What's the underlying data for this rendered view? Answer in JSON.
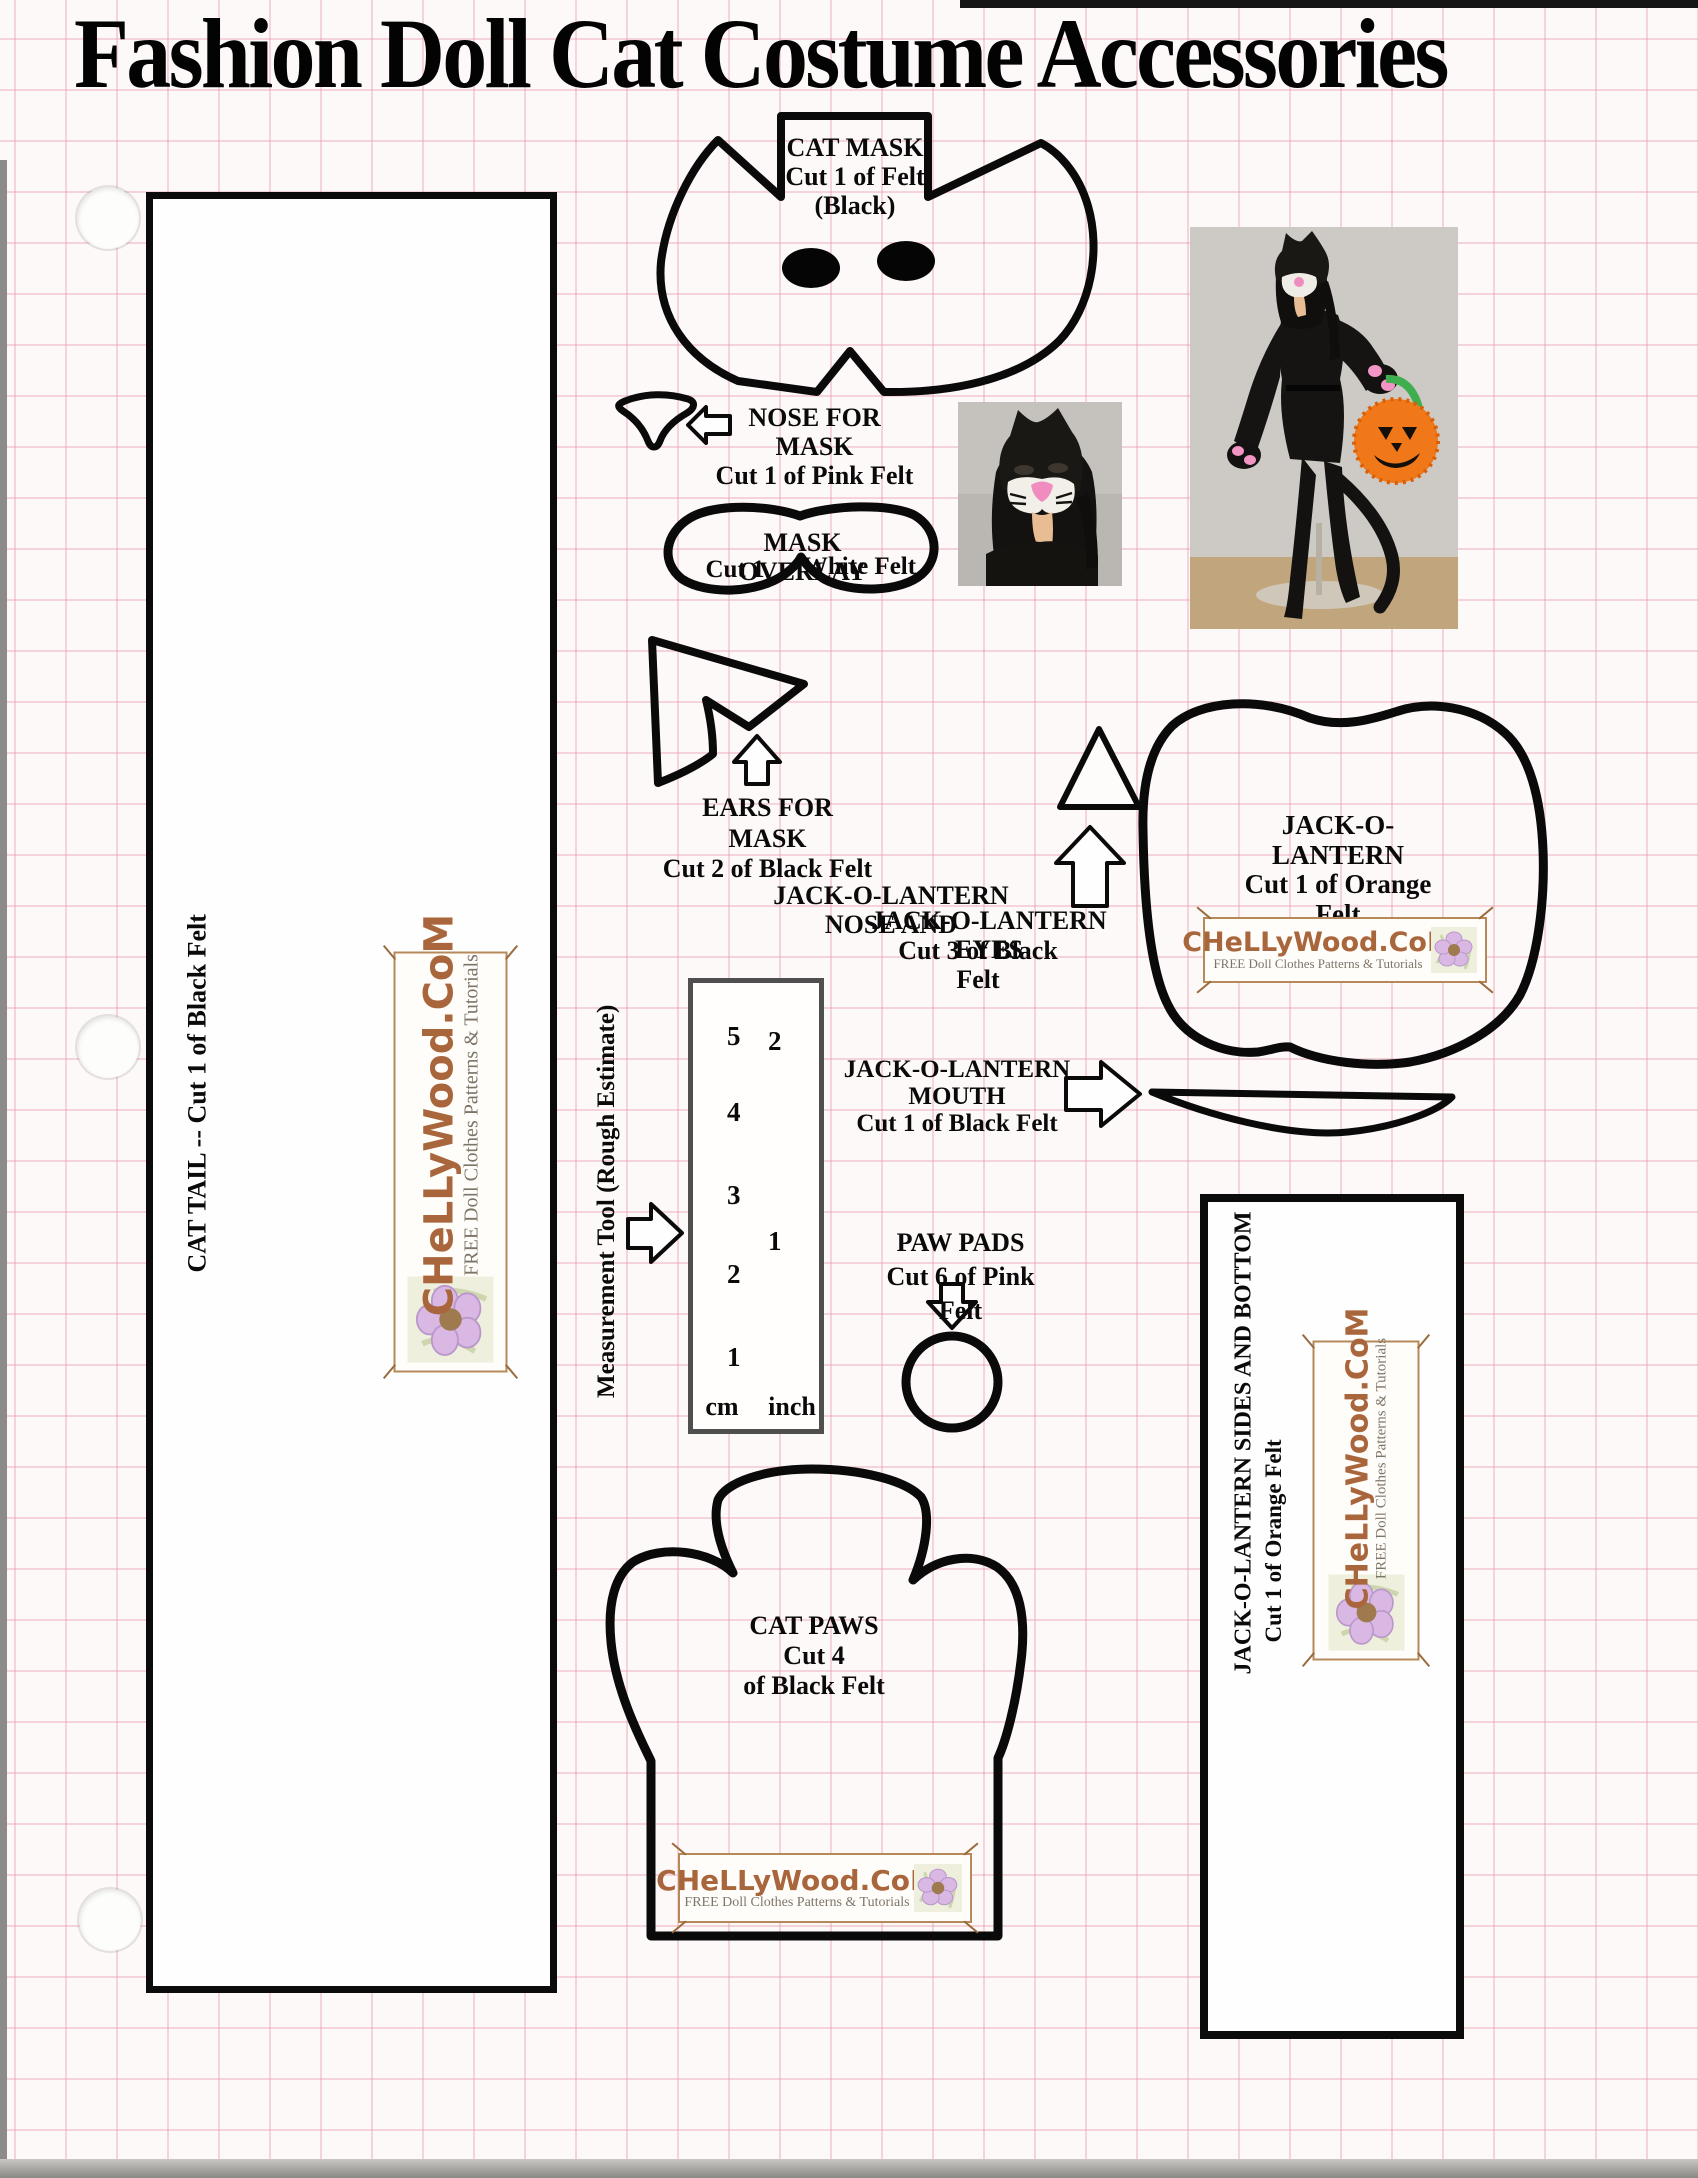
{
  "page": {
    "title": "Fashion Doll Cat Costume Accessories"
  },
  "patterns": {
    "cat_mask": {
      "line1": "CAT MASK",
      "line2": "Cut 1 of Felt",
      "line3": "(Black)"
    },
    "nose_for_mask": {
      "line1": "NOSE FOR MASK",
      "line2": "Cut 1 of Pink Felt"
    },
    "mask_overlay": {
      "line1": "MASK OVERLAY",
      "cut": "Cut 1",
      "material": "White Felt"
    },
    "ears_for_mask": {
      "line1": "EARS FOR MASK",
      "line2": "Cut 2 of Black Felt"
    },
    "jol_nose_eyes": {
      "line1": "JACK-O-LANTERN NOSE AND",
      "line2": "JACK-O-LANTERN EYES",
      "line3": "Cut 3 of Black Felt"
    },
    "jack_o_lantern": {
      "line1": "JACK-O-LANTERN",
      "line2": "Cut 1 of Orange",
      "line3": "Felt"
    },
    "jol_mouth": {
      "line1": "JACK-O-LANTERN MOUTH",
      "line2": "Cut 1 of Black Felt"
    },
    "paw_pads": {
      "line1": "PAW PADS",
      "line2": "Cut 6 of Pink Felt"
    },
    "cat_paws": {
      "line1": "CAT PAWS",
      "line2": "Cut 4",
      "line3": "of Black Felt"
    },
    "cat_tail": {
      "label": "CAT TAIL -- Cut 1 of Black Felt"
    },
    "jol_sides": {
      "line1": "JACK-O-LANTERN SIDES AND BOTTOM",
      "line2": "Cut 1 of Orange Felt"
    }
  },
  "ruler": {
    "label": "Measurement Tool (Rough Estimate)",
    "cm_marks": [
      "5",
      "4",
      "3",
      "2",
      "1"
    ],
    "inch_marks": [
      "2",
      "1"
    ],
    "cm_label": "cm",
    "inch_label": "inch"
  },
  "logo": {
    "title": "CHeLLyWood.CoM",
    "subtitle": "FREE Doll Clothes Patterns & Tutorials"
  },
  "colors": {
    "outline": "#000000",
    "grid_pink": "#e696aa",
    "logo_brown": "#a9663c",
    "flower_purple": "#d9b9e4",
    "paper": "#fdf9f8"
  }
}
